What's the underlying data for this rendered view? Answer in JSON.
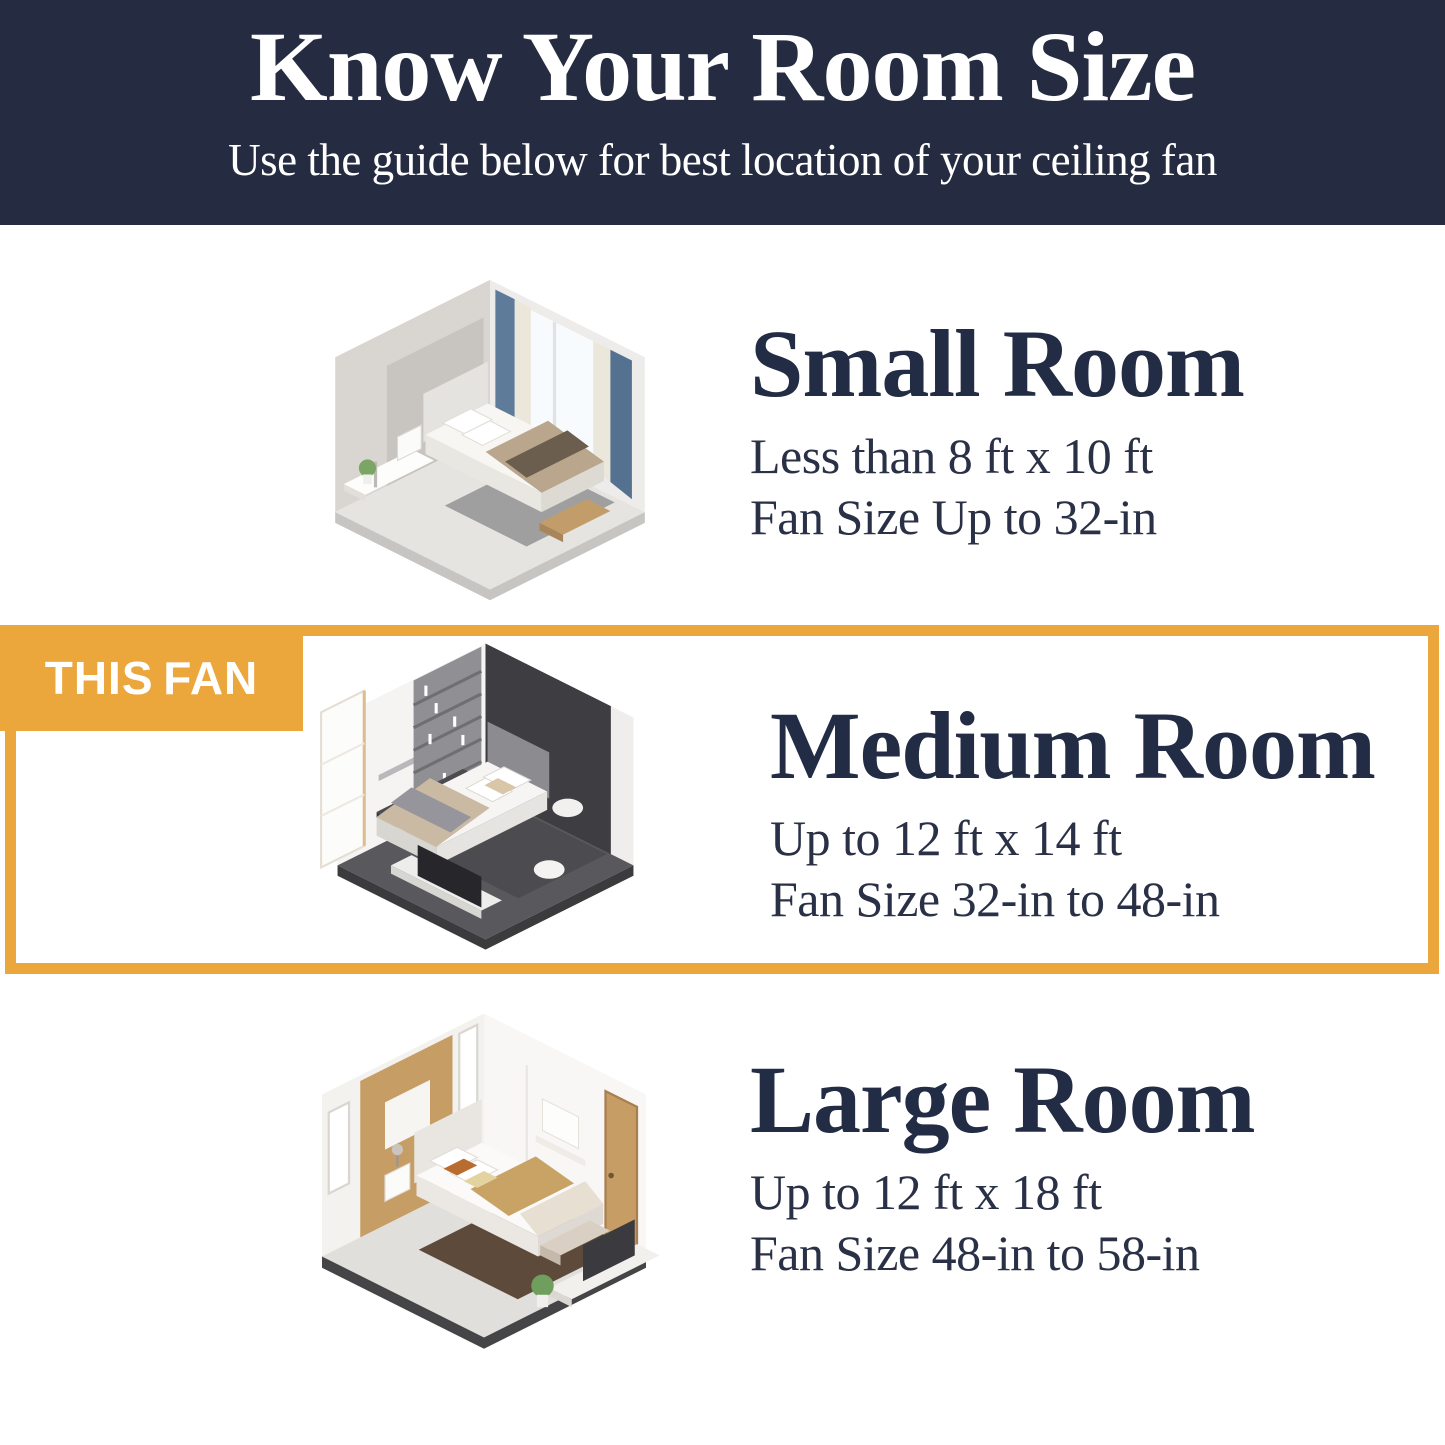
{
  "header": {
    "title": "Know Your Room Size",
    "subtitle": "Use the guide below for best location of your ceiling fan"
  },
  "highlight_badge": {
    "label": "THIS FAN"
  },
  "rooms": [
    {
      "name": "small",
      "title": "Small Room",
      "size_range": "Less than 8 ft x 10 ft",
      "fan_size": "Fan Size Up to 32-in",
      "illustration": "small-bedroom-isometric-render",
      "highlighted": false
    },
    {
      "name": "medium",
      "title": "Medium Room",
      "size_range": "Up to 12 ft x 14 ft",
      "fan_size": "Fan Size 32-in to 48-in",
      "illustration": "medium-bedroom-isometric-render",
      "highlighted": true
    },
    {
      "name": "large",
      "title": "Large Room",
      "size_range": "Up to 12 ft x 18 ft",
      "fan_size": "Fan Size 48-in to 58-in",
      "illustration": "large-bedroom-isometric-render",
      "highlighted": false
    }
  ],
  "colors": {
    "header_background": "#252b40",
    "accent_yellow": "#eba63c",
    "headline_text": "#ffffff",
    "body_text": "#2a3147"
  }
}
